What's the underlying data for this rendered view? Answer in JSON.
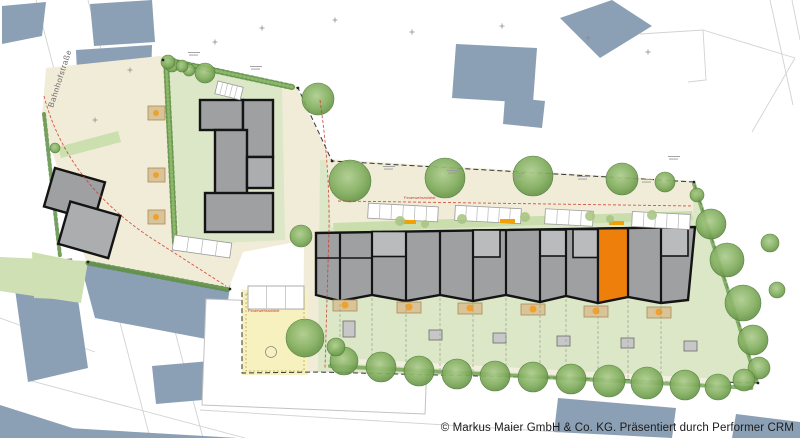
{
  "plan": {
    "street_label": "Bahnhofstraße",
    "annotations": {
      "fire_access": "Feuerwehrzufahrt"
    },
    "row": {
      "unit_count": 12,
      "highlighted_unit": 10
    },
    "colors": {
      "existing_building": "#8BA0B5",
      "new_building": "#9FA0A2",
      "new_building_light": "#BABBBD",
      "highlight": "#EE7F0B",
      "lawn": "#DBE7C6",
      "paving": "#F1ECD8",
      "playground": "#F6F1BE",
      "hedge": "#5E8F46",
      "outline": "#141414"
    }
  },
  "footer": {
    "copyright": "© Markus Maier GmbH & Co. KG. Präsentiert durch Performer CRM"
  }
}
